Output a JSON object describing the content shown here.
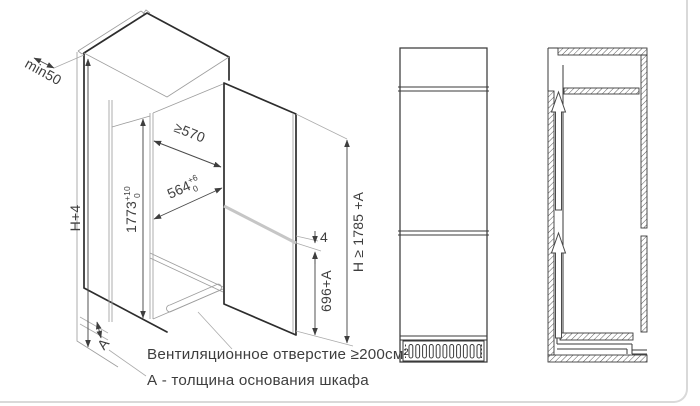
{
  "iso": {
    "min_gap": "min50",
    "depth": "≥570",
    "width_main": "564",
    "width_sup": "+6",
    "width_sub": "0",
    "niche_main": "1773",
    "niche_sup": "+10",
    "niche_sub": "0",
    "cabinet_height": "H+4",
    "door_gap": "4",
    "freezer_height": "696+A",
    "total_height": "H ≥ 1785 +A",
    "base_thickness": "А"
  },
  "captions": {
    "vent": "Вентиляционное отверстие ≥200см²",
    "base": "А - толщина основания шкафа"
  },
  "colors": {
    "line_heavy": "#2d2d2d",
    "line_thin": "#9e9e9e",
    "frame_border": "#d9d9d9",
    "text": "#3e3e3e"
  }
}
